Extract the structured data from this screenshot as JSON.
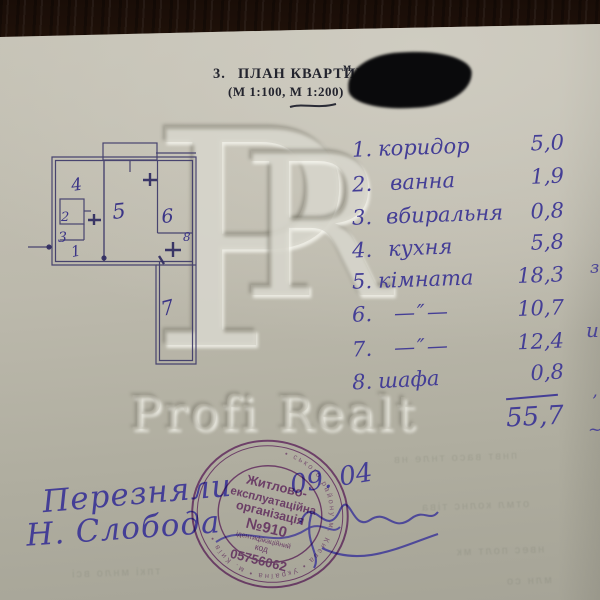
{
  "header": {
    "number": "3.",
    "title": "ПЛАН КВАРТИРИ",
    "scale": "(М 1:100, М 1:200)",
    "redacted_visible": "м"
  },
  "plan": {
    "labels": {
      "l1": "1",
      "l2": "2",
      "l3": "3",
      "l4": "4",
      "l5": "5",
      "l6": "6",
      "l7": "7",
      "l8": "8"
    }
  },
  "list": {
    "items": [
      {
        "num": "1.",
        "name": "коридор",
        "value": "5,0"
      },
      {
        "num": "2.",
        "name": "ванна",
        "value": "1,9"
      },
      {
        "num": "3.",
        "name": "вбиральня",
        "value": "0,8"
      },
      {
        "num": "4.",
        "name": "кухня",
        "value": "5,8"
      },
      {
        "num": "5.",
        "name": "кімната",
        "value": "18,3"
      },
      {
        "num": "6.",
        "name": "—″—",
        "value": "10,7"
      },
      {
        "num": "7.",
        "name": "—″—",
        "value": "12,4"
      },
      {
        "num": "8.",
        "name": "шафа",
        "value": "0,8"
      }
    ],
    "total": "55,7"
  },
  "watermark": {
    "letter_p": "P",
    "letter_r": "R",
    "name": "Profi Realt"
  },
  "stamp": {
    "org_line1": "Житлово-",
    "org_line2": "експлуатаційна",
    "org_line3": "організація",
    "org_number": "№910",
    "id_label": "ідентифікаційний",
    "code_label": "код",
    "code_value": "05756062",
    "ring_text": "• ського району м. Києва • Україна • м. Київ •"
  },
  "annotations": {
    "line1": "Перезняли",
    "line2": "Н. Слобода",
    "date": "09. 04"
  },
  "edge_marks": {
    "m1": "з",
    "m2": "и",
    "m3": "’",
    "m4": "~"
  },
  "artifacts": {
    "bleed1": "пнвт васо тнле нв",
    "bleed2": "отмл колнс тіва",
    "bleed3": "нвес полт мк",
    "bleed4": "тпкі мнло всі",
    "bleed5": "млн со"
  },
  "colors": {
    "paper": "#bcb9ac",
    "wood": "#341d0f",
    "ink": "#443e96",
    "plan_line": "#3b3768",
    "stamp": "#8d4096",
    "print": "#23242e"
  }
}
